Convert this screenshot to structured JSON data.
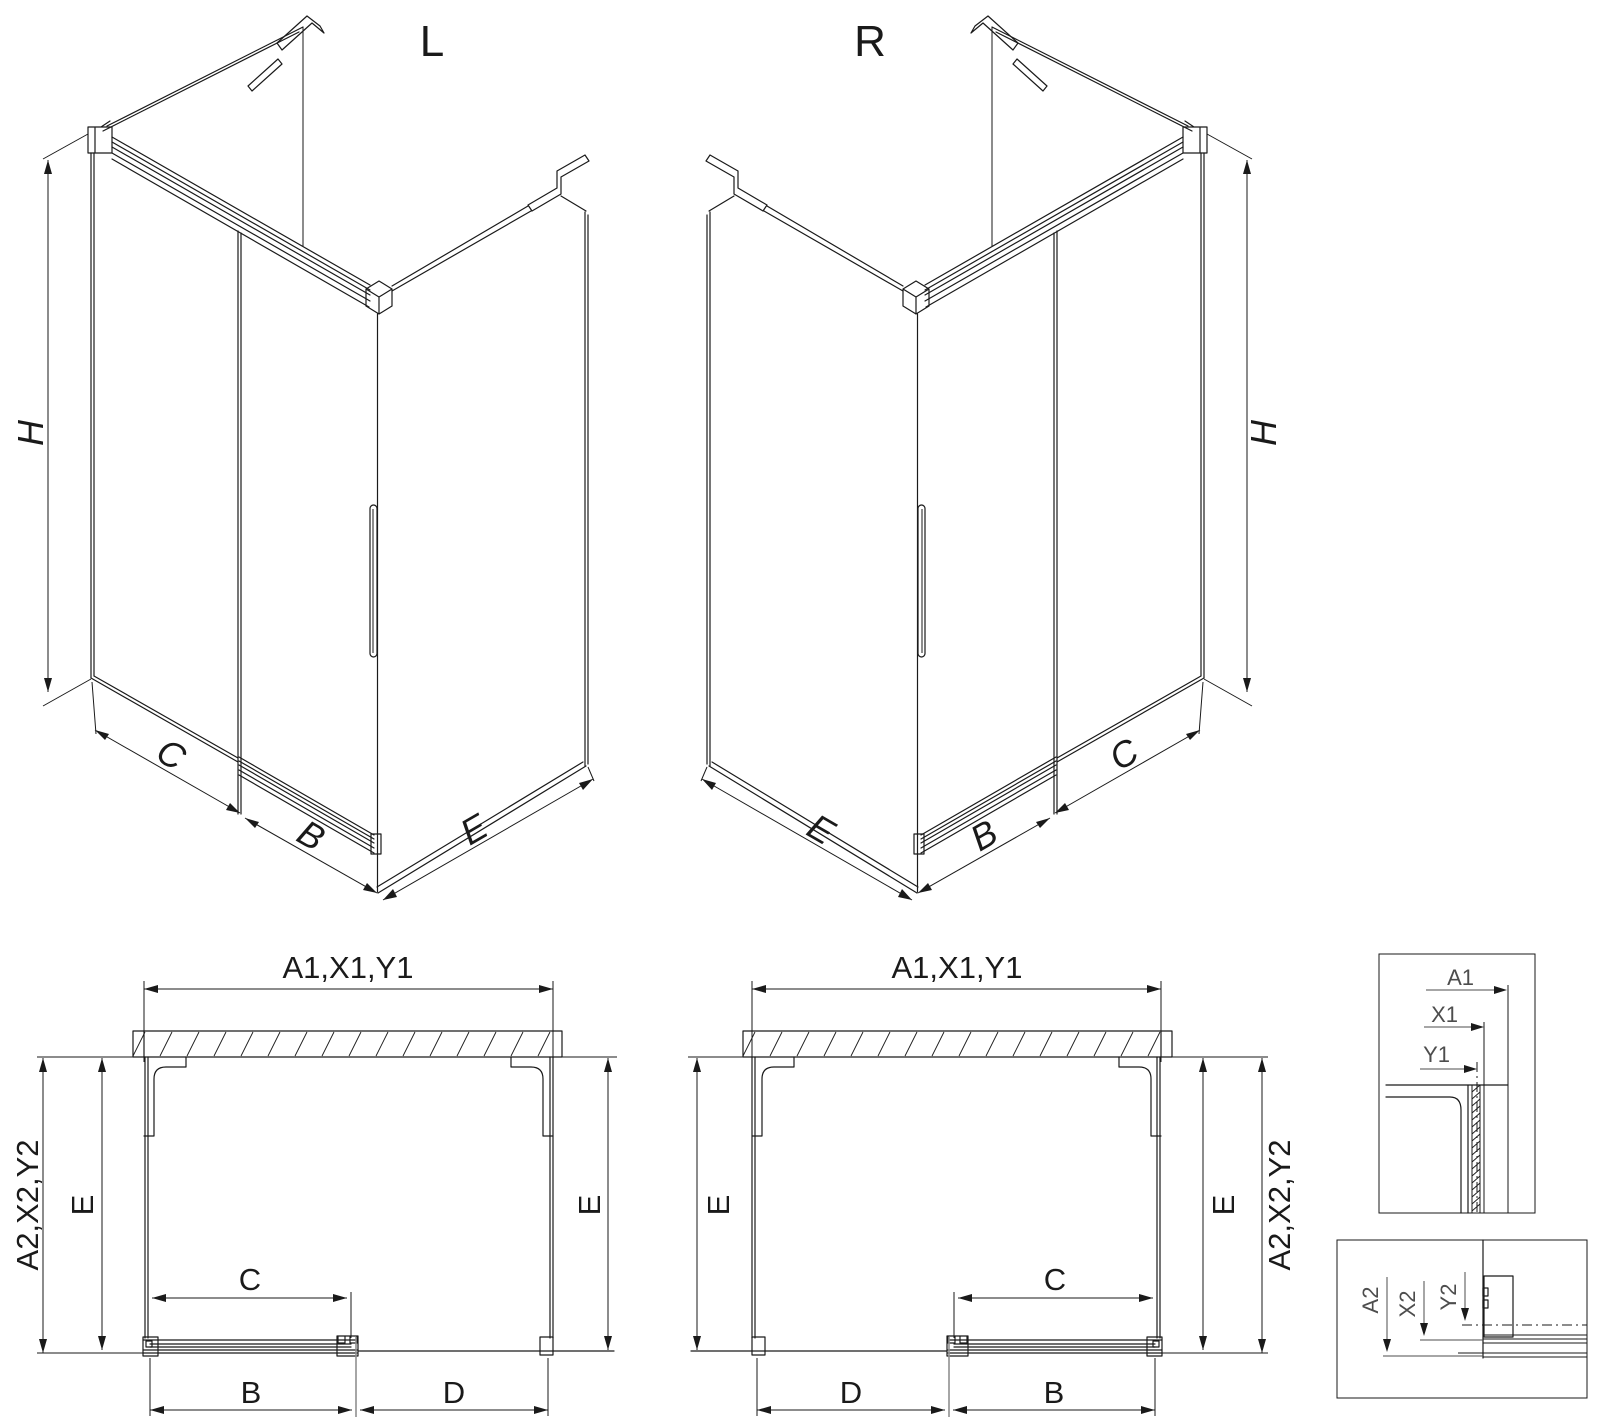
{
  "drawing": {
    "type": "shower-enclosure-technical-drawing",
    "background": "#ffffff",
    "line_color": "#1a1a1a",
    "detail_text_color": "#4d4d4d"
  },
  "iso_left": {
    "label": "L",
    "dim_height": "H",
    "dim_c": "C",
    "dim_b": "B",
    "dim_e": "E"
  },
  "iso_right": {
    "label": "R",
    "dim_height": "H",
    "dim_c": "C",
    "dim_b": "B",
    "dim_e": "E"
  },
  "plan_left": {
    "dim_top": "A1,X1,Y1",
    "dim_side": "A2,X2,Y2",
    "dim_e_left": "E",
    "dim_e_right": "E",
    "dim_c": "C",
    "dim_b": "B",
    "dim_d": "D"
  },
  "plan_right": {
    "dim_top": "A1,X1,Y1",
    "dim_side": "A2,X2,Y2",
    "dim_e_left": "E",
    "dim_e_right": "E",
    "dim_c": "C",
    "dim_b": "B",
    "dim_d": "D"
  },
  "detail_top": {
    "dim_a1": "A1",
    "dim_x1": "X1",
    "dim_y1": "Y1"
  },
  "detail_bottom": {
    "dim_a2": "A2",
    "dim_x2": "X2",
    "dim_y2": "Y2"
  }
}
